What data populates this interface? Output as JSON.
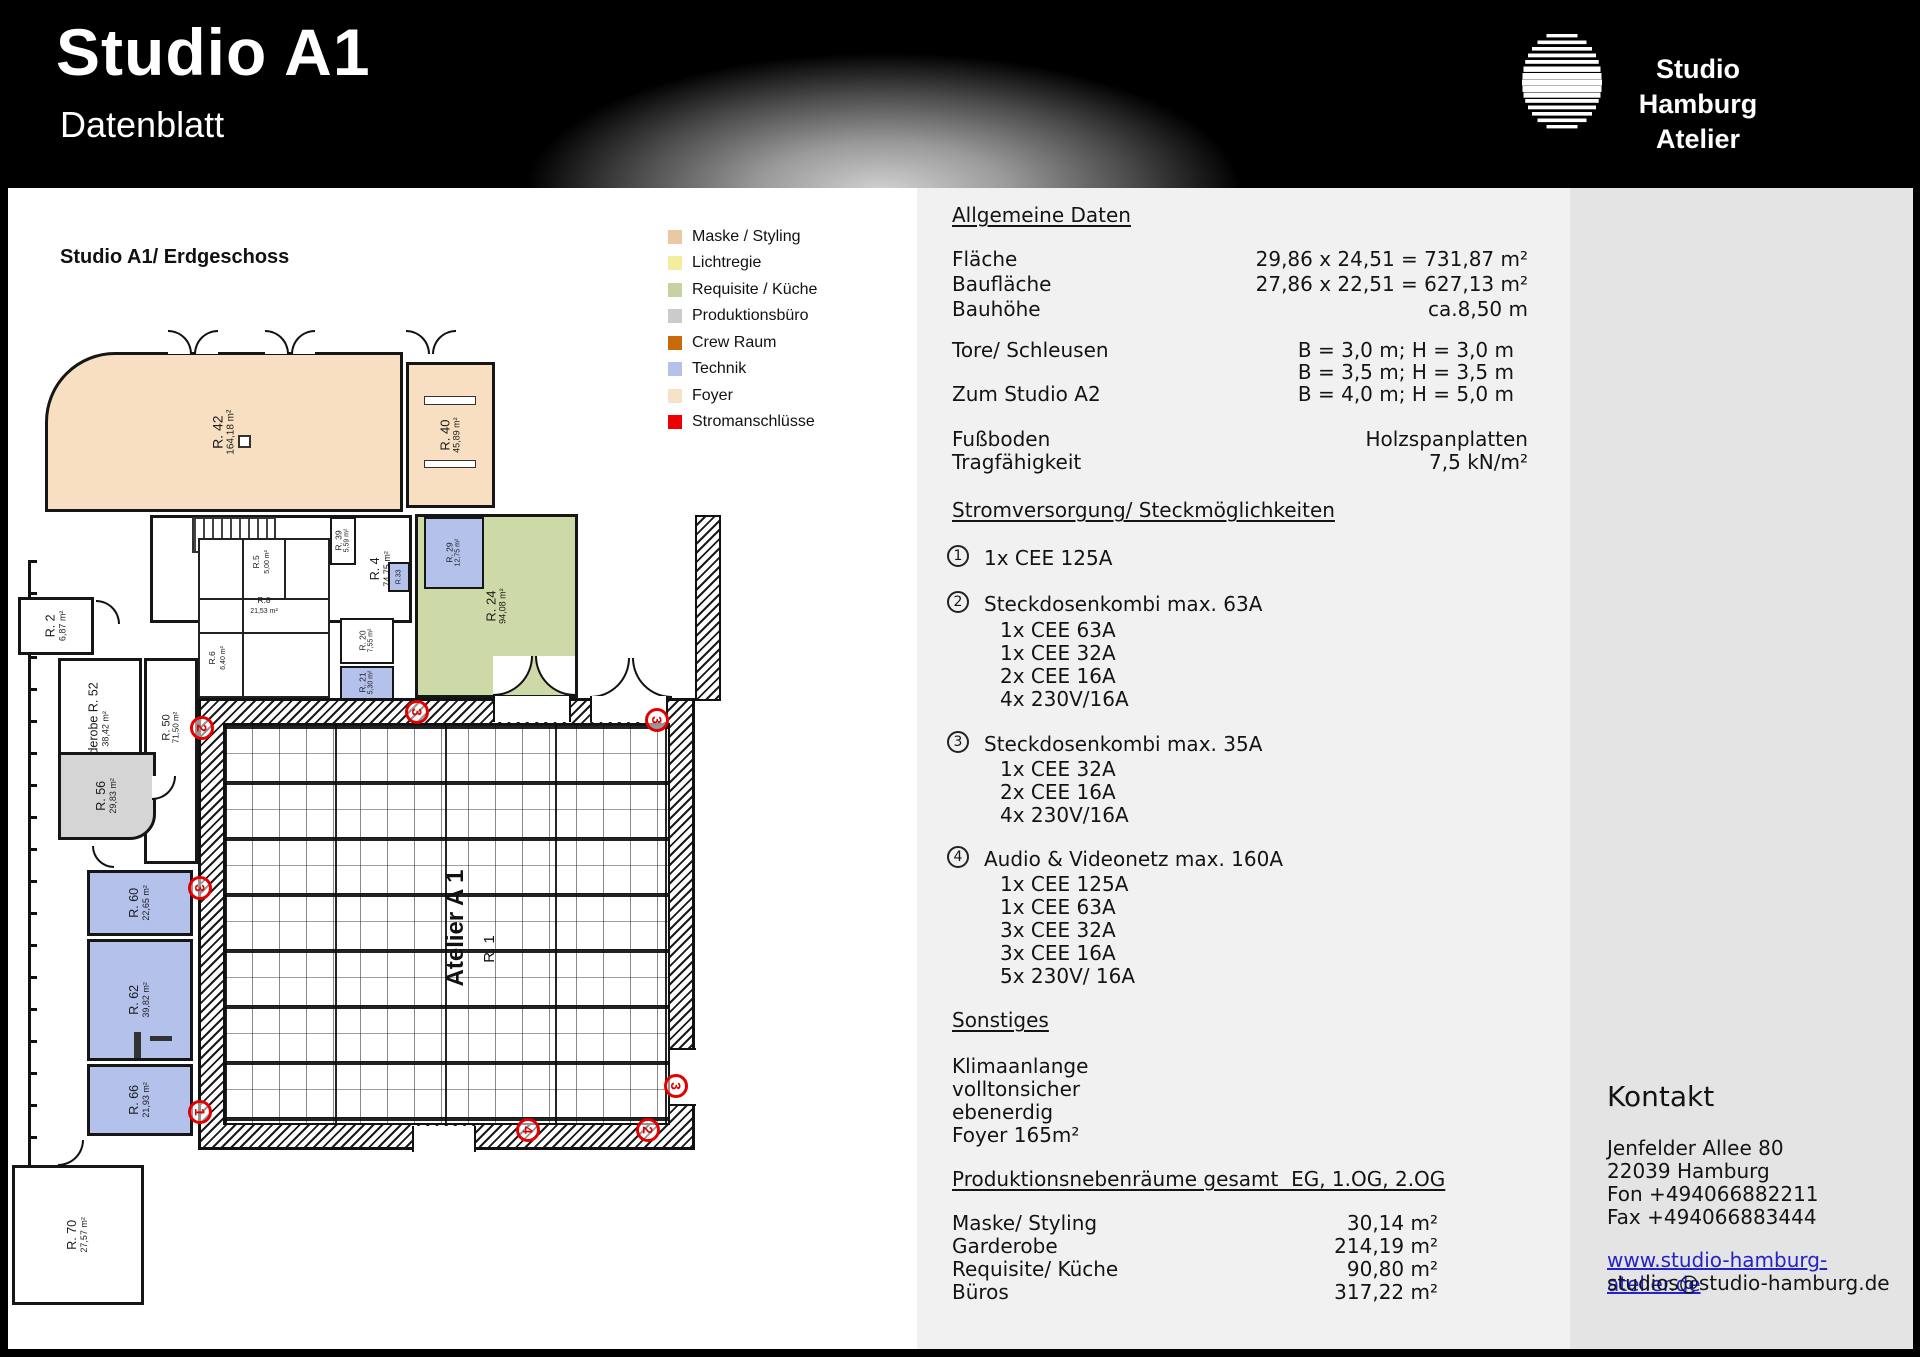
{
  "header": {
    "title": "Studio A1",
    "subtitle": "Datenblatt",
    "logo_line1": "Studio Hamburg",
    "logo_line2": "Atelier"
  },
  "floorplan": {
    "title": "Studio A1/ Erdgeschoss",
    "legend": [
      {
        "label": "Maske / Styling",
        "color": "#ebc8a4"
      },
      {
        "label": "Lichtregie",
        "color": "#f2ee9b"
      },
      {
        "label": "Requisite / Küche",
        "color": "#c6d2a0"
      },
      {
        "label": "Produktionsbüro",
        "color": "#cbcbcb"
      },
      {
        "label": "Crew Raum",
        "color": "#c76b08"
      },
      {
        "label": "Technik",
        "color": "#b5c1e9"
      },
      {
        "label": "Foyer",
        "color": "#f5e3c8"
      },
      {
        "label": "Stromanschlüsse",
        "color": "#ee0000"
      }
    ],
    "studio_label": "Atelier A 1",
    "studio_room": "R. 1",
    "rooms": [
      {
        "name": "R. 42",
        "area": "164,18 m²"
      },
      {
        "name": "R. 40",
        "area": "45,89 m²"
      },
      {
        "name": "R. 4",
        "area": "74,75 m²"
      },
      {
        "name": "R. 2",
        "area": "6,87 m²"
      },
      {
        "name": "Garderobe  R. 52",
        "area": "38,42 m²"
      },
      {
        "name": "R. 50",
        "area": "71,50 m²"
      },
      {
        "name": "R. 56",
        "area": "29,83 m²"
      },
      {
        "name": "R. 60",
        "area": "22,65 m²"
      },
      {
        "name": "R. 62",
        "area": "39,82 m²"
      },
      {
        "name": "R. 66",
        "area": "21,93 m²"
      },
      {
        "name": "R. 70",
        "area": "27,57 m²"
      },
      {
        "name": "R. 24",
        "area": "94,08 m²"
      },
      {
        "name": "R. 29",
        "area": "12,75 m²"
      },
      {
        "name": "R. 20",
        "area": "7,55 m²"
      },
      {
        "name": "R. 21",
        "area": "5,30 m²"
      },
      {
        "name": "R. 39",
        "area": "5,59 m²"
      },
      {
        "name": "R.8",
        "area": "21,53 m²"
      },
      {
        "name": "R.5",
        "area": "5,00 m²"
      },
      {
        "name": "R.6",
        "area": "6,40 m²"
      },
      {
        "name": "R.33",
        "area": "2,01 m²"
      }
    ],
    "markers": [
      "2",
      "3",
      "3",
      "3",
      "1",
      "4",
      "2",
      "3"
    ]
  },
  "general": {
    "heading": "Allgemeine Daten",
    "rows": [
      {
        "label": "Fläche",
        "value": "29,86 x 24,51 = 731,87 m²"
      },
      {
        "label": "Baufläche",
        "value": "27,86 x 22,51 = 627,13 m²"
      },
      {
        "label": "Bauhöhe",
        "value": "ca.8,50 m"
      }
    ],
    "rows2": [
      {
        "label": "Tore/ Schleusen",
        "value": "B = 3,0 m; H = 3,0 m"
      },
      {
        "label": "",
        "value": "B = 3,5 m; H = 3,5 m"
      },
      {
        "label": "Zum Studio A2",
        "value": "B = 4,0 m; H = 5,0 m"
      }
    ],
    "rows3": [
      {
        "label": "Fußboden",
        "value": "Holzspanplatten"
      },
      {
        "label": "Tragfähigkeit",
        "value": "7,5 kN/m²"
      }
    ]
  },
  "power": {
    "heading": "Stromversorgung/ Steckmöglichkeiten",
    "groups": [
      {
        "num": "1",
        "title": "1x CEE 125A",
        "items": []
      },
      {
        "num": "2",
        "title": "Steckdosenkombi max. 63A",
        "items": [
          "1x CEE 63A",
          "1x CEE 32A",
          "2x CEE 16A",
          "4x 230V/16A"
        ]
      },
      {
        "num": "3",
        "title": "Steckdosenkombi max. 35A",
        "items": [
          "1x CEE 32A",
          "2x CEE 16A",
          "4x 230V/16A"
        ]
      },
      {
        "num": "4",
        "title": "Audio & Videonetz max. 160A",
        "items": [
          "1x CEE 125A",
          "1x CEE 63A",
          "3x CEE 32A",
          "3x CEE 16A",
          "5x 230V/ 16A"
        ]
      }
    ]
  },
  "misc": {
    "heading": "Sonstiges",
    "items": [
      "Klimaanlange",
      "volltonsicher",
      "ebenerdig",
      "Foyer 165m²"
    ]
  },
  "siderooms": {
    "heading": "Produktionsnebenräume gesamt  EG, 1.OG, 2.OG",
    "rows": [
      {
        "label": "Maske/ Styling",
        "value": "30,14 m²"
      },
      {
        "label": "Garderobe",
        "value": "214,19 m²"
      },
      {
        "label": "Requisite/ Küche",
        "value": "90,80 m²"
      },
      {
        "label": "Büros",
        "value": "317,22 m²"
      }
    ]
  },
  "contact": {
    "heading": "Kontakt",
    "lines": [
      "Jenfelder Allee 80",
      "22039 Hamburg",
      "Fon +494066882211",
      "Fax +494066883444"
    ],
    "website": "www.studio-hamburg-atelier.de",
    "email": "studios@studio-hamburg.de"
  }
}
